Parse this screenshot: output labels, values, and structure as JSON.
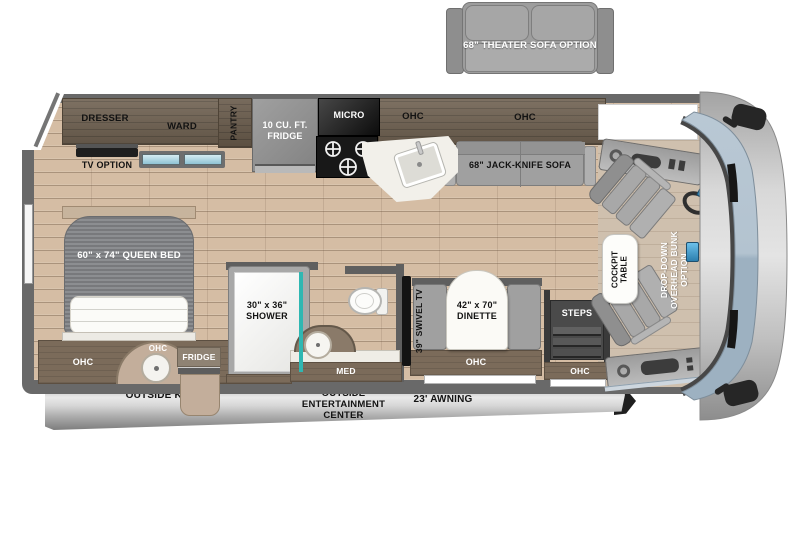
{
  "title": "Motorhome floor plan",
  "colors": {
    "wall": "#696969",
    "floor_wood": "#d5bda4",
    "dark_cabinet": "#6f6151",
    "brown_cabinet": "#7b6b5a",
    "tan": "#c3ae9b",
    "gray_furniture": "#a0a0a0",
    "teal_accent": "#2fb7b2",
    "windshield_blue": "#a9bccb",
    "awning_silver": "#c9c9c9"
  },
  "options": {
    "theater_sofa": "68\" THEATER SOFA OPTION",
    "tv_option": "TV OPTION",
    "drop_down_bunk": "DROP-DOWN OVERHEAD BUNK OPTION"
  },
  "bedroom": {
    "dresser": "DRESSER",
    "ward": "WARD",
    "queen_bed": "60\" x 74\" QUEEN BED",
    "ohc": "OHC",
    "ohc_sink": "OHC",
    "outside_fridge": "FRIDGE"
  },
  "kitchen": {
    "pantry": "PANTRY",
    "fridge": "10 CU. FT. FRIDGE",
    "micro": "MICRO",
    "ohc": "OHC"
  },
  "living": {
    "ohc": "OHC",
    "jack_knife_sofa": "68\" JACK-KNIFE SOFA",
    "swivel_tv": "39\" SWIVEL TV",
    "dinette": "42\" x 70\" DINETTE",
    "dinette_ohc": "OHC"
  },
  "bath": {
    "shower": "30\" x 36\" SHOWER",
    "med": "MED"
  },
  "entry": {
    "steps": "STEPS",
    "ohc": "OHC"
  },
  "cockpit": {
    "table": "COCKPIT TABLE"
  },
  "exterior": {
    "outside_kitchen": "OUTSIDE KITCHEN",
    "outside_entertainment": "OUTSIDE ENTERTAINMENT CENTER",
    "awning": "23' AWNING"
  }
}
